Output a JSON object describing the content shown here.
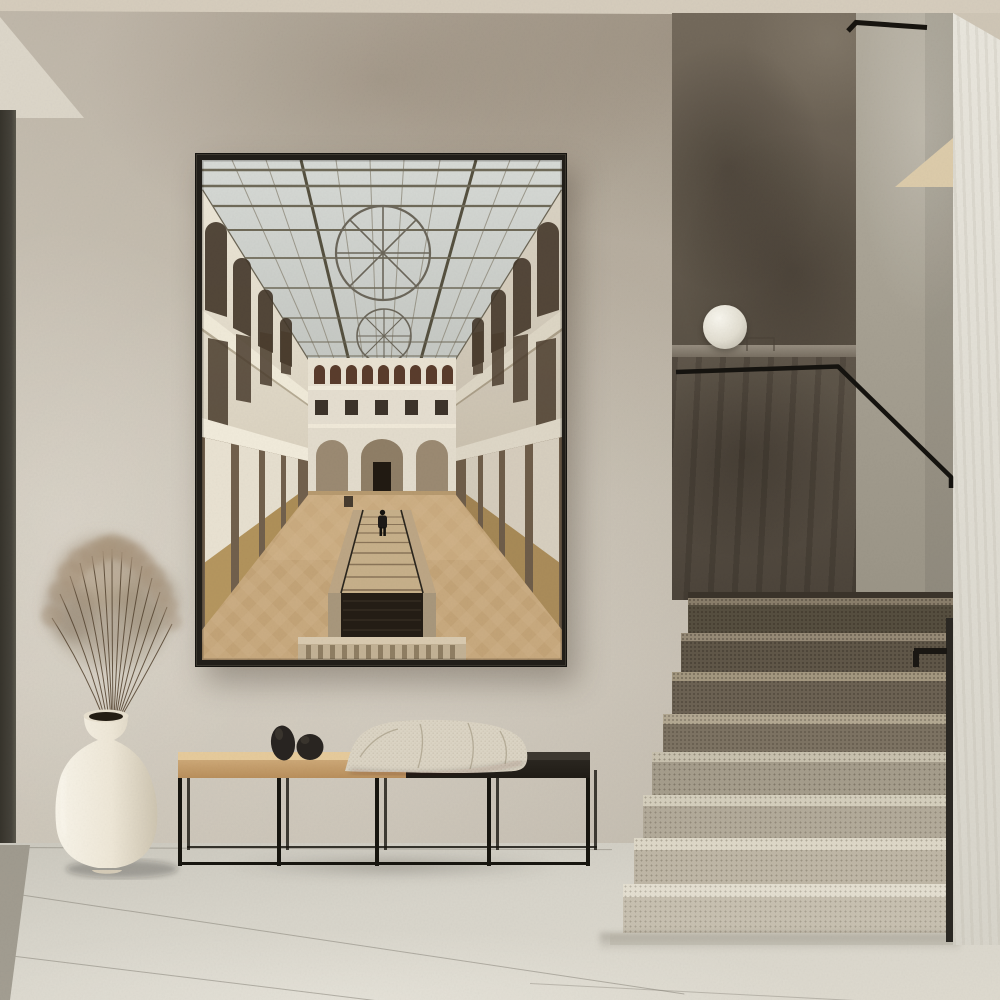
{
  "scene": {
    "title": "Minimalist hallway interior with framed atrium print, bench, vase and concrete staircase",
    "objects": {
      "poster": {
        "label": "Framed photographic print of a classical museum atrium with glass roof and central staircase",
        "frame_color": "#211e19"
      },
      "poster_art": {
        "label": "Atrium photo: skylight with circular glazing motif, tiered arched galleries, tan stone floor, central stair with lone figure",
        "glass_color": "#ccd0cc",
        "wall_color": "#e7e0d0",
        "floor_color": "#c8a97e",
        "figure_color": "#1d1a17"
      },
      "bench": {
        "label": "Low bench with thin black steel frame and two-tone wood seat",
        "wood_light": "#cda877",
        "wood_dark": "#2a2620",
        "frame_color": "#17150f"
      },
      "blanket": {
        "label": "Cream knitted throw draped over the bench seat",
        "color": "#dcd5c5"
      },
      "pebbles": {
        "label": "Two black egg-shaped stone decor objects on the bench",
        "color": "#292521"
      },
      "vase": {
        "label": "Cream ceramic floor vase with narrow flared neck",
        "color": "#f0e9db"
      },
      "pampas": {
        "label": "Dried pampas grass stems fanning from the vase",
        "plume_color": "#a08c74",
        "stem_color": "#54432f"
      },
      "staircase": {
        "label": "Terrazzo staircase, dark upper treads in shadow fading to cream at the bottom",
        "step_dark": "#605748",
        "step_light": "#e4dfd1"
      },
      "handrail": {
        "label": "Thin black metal handrail along the stair wall",
        "color": "#17140f"
      },
      "lamp": {
        "label": "White sphere lamp resting on the concrete landing ledge",
        "color": "#f2f0e8"
      },
      "walls": {
        "label": "Mottled limewash plaster wall",
        "color": "#c2baac"
      },
      "dark_wall": {
        "label": "Dark taupe plaster stairwell wall",
        "color": "#5f564a"
      },
      "ceiling": {
        "label": "Warm beige ceiling band",
        "color": "#d0c7b7"
      },
      "floor": {
        "label": "Large-format light stone tile floor",
        "color": "#d6d3c9"
      },
      "door_edge": {
        "label": "Dark door/glazing edge at far left",
        "color": "#3e3b32"
      }
    }
  }
}
